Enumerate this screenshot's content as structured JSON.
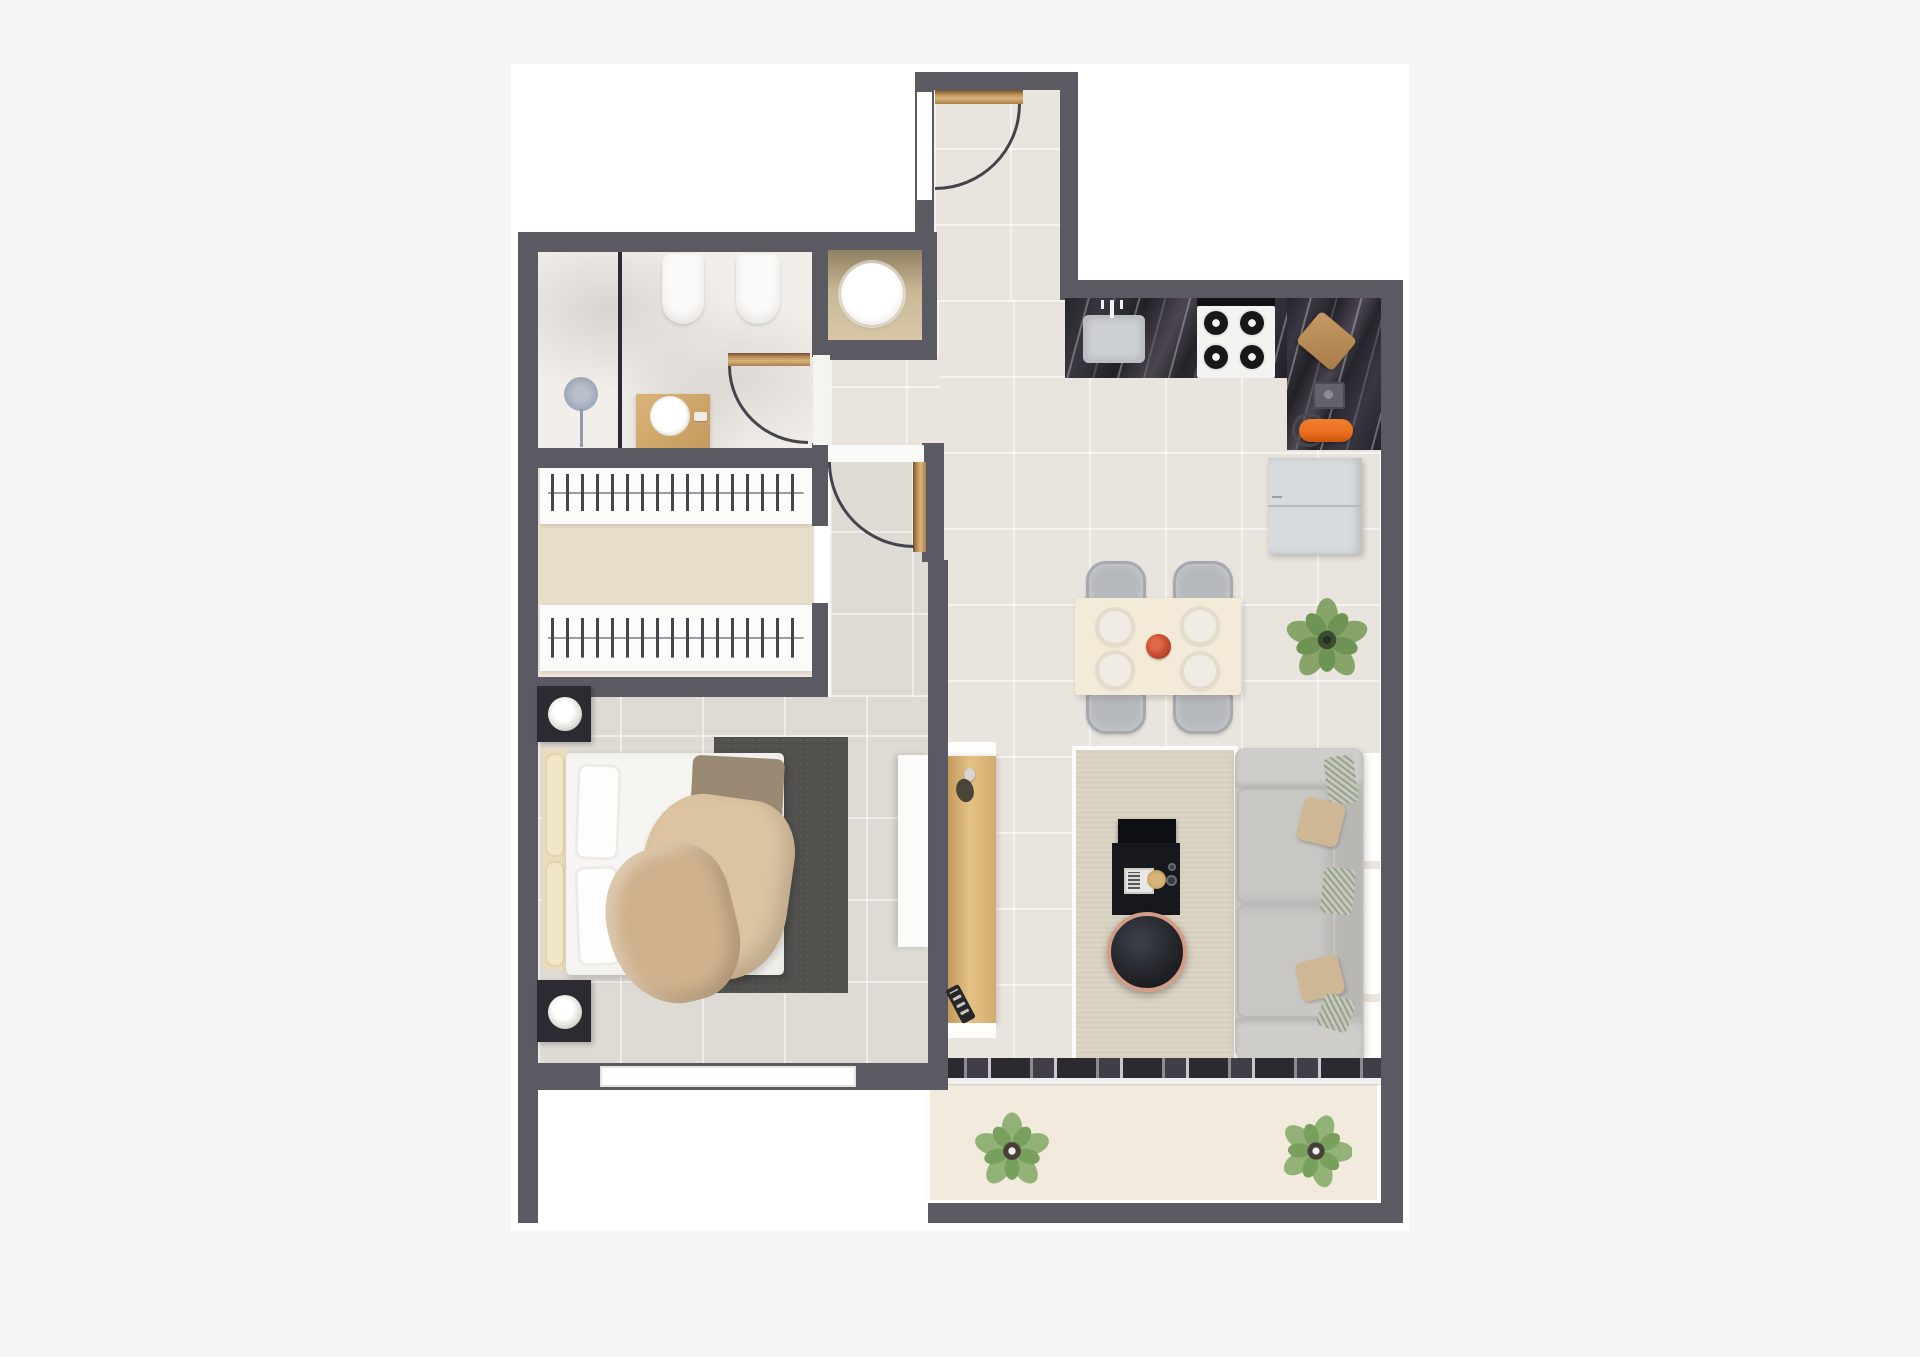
{
  "scene": {
    "kind": "3d-apartment-floor-plan-render",
    "orientation": "top-down",
    "visible_text": "none"
  },
  "colors": {
    "page_bg": "#f5f5f6",
    "canvas_bg": "#ffffff",
    "wall": "#5b5a62",
    "floor_tile": "#e9e5de",
    "bedroom_floor": "#dedad4",
    "bathroom_floor": "#f2efeb",
    "closet_floor": "#efe8da",
    "closet_strip": "#e7dec9",
    "balcony_floor": "#f2ebdd",
    "counter_marble": "#2c2a32",
    "wood_door": "#c9a36b",
    "console_wood": "#dcb577",
    "rug_living": "#d7d0bf",
    "rug_bedroom": "#52504d",
    "sofa": "#c6c4c1",
    "sofa_back": "#b9b7b4",
    "bed_duvet": "#f7f5f2",
    "headboard_cream": "#eadcbe",
    "blanket_beige": "#dcc4a2",
    "blanket_deep": "#cfb28d",
    "table_cream": "#f3ead7",
    "chair_gray": "#b4b7bb",
    "plant_green": "#87a56b",
    "plant_green_dark": "#5f8a4d",
    "accent_orange": "#e96f1f",
    "accent_red_bowl": "#c0452f",
    "copper_rim": "#d39c85",
    "tv_black": "#17181d",
    "nightstand_dark": "#2c2b31",
    "fridge_gray": "#d8dbde",
    "fixture_white": "#fbfaf8",
    "shower_gray": "#9aa4b4"
  },
  "rooms": [
    {
      "name": "entry-hall"
    },
    {
      "name": "bathroom"
    },
    {
      "name": "laundry-niche"
    },
    {
      "name": "walk-in-closet"
    },
    {
      "name": "bedroom"
    },
    {
      "name": "kitchen"
    },
    {
      "name": "dining-area"
    },
    {
      "name": "living-room"
    },
    {
      "name": "balcony"
    }
  ],
  "furniture": [
    "entry-door",
    "bathroom-door",
    "bedroom-door",
    "shower",
    "bidet",
    "toilet",
    "vanity-sink",
    "washing-machine",
    "wardrobe-rail-top",
    "wardrobe-rail-bottom",
    "double-bed",
    "nightstand-lamp-top",
    "nightstand-lamp-bottom",
    "bedroom-rug",
    "dresser",
    "kitchen-sink",
    "gas-stove",
    "cutting-board",
    "coffee-machine",
    "orange-utensil",
    "fridge",
    "dining-table",
    "dining-chairs",
    "dinner-plates",
    "centerpiece-bowl",
    "potted-plant-dining",
    "console-table",
    "remote-control",
    "tv-unit",
    "round-coffee-table",
    "sofa",
    "cushions",
    "living-rug",
    "sliding-door-threshold",
    "balcony-plant-left",
    "balcony-plant-right"
  ]
}
